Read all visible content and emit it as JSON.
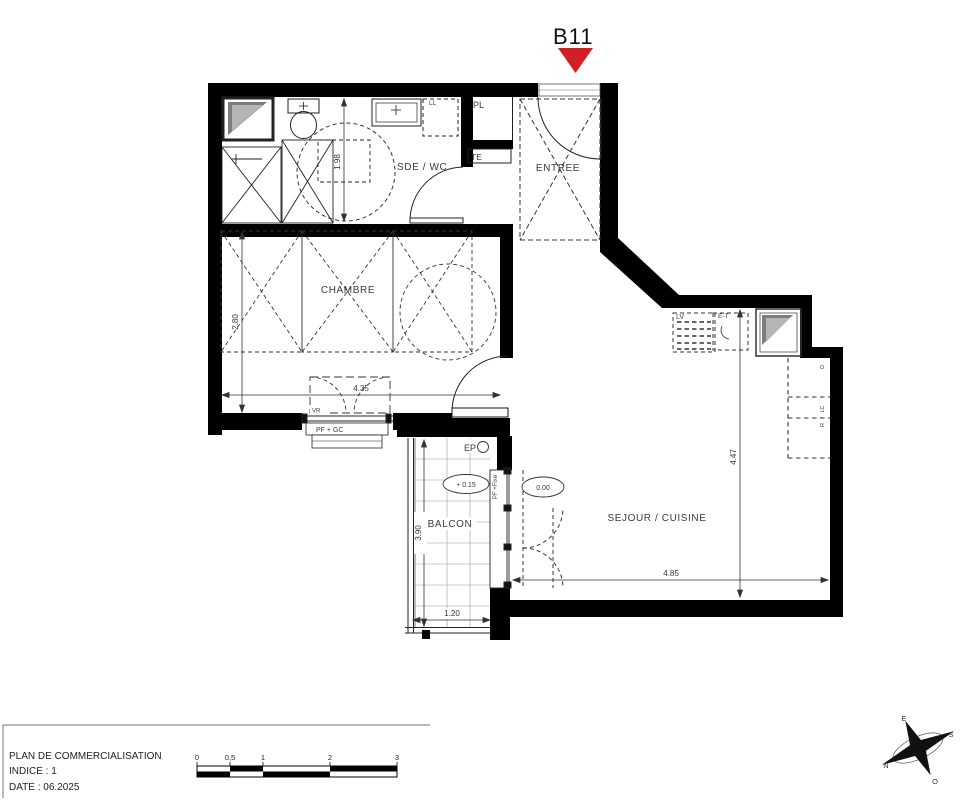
{
  "unit_marker": {
    "label": "B11"
  },
  "colors": {
    "wall": "#000000",
    "marker_red": "#d11f26",
    "text": "#333333"
  },
  "rooms": {
    "sde_wc": "SDE / WC",
    "entree": "ENTREE",
    "chambre": "CHAMBRE",
    "sejour": "SEJOUR / CUISINE",
    "balcon": "BALCON"
  },
  "fixtures": {
    "ll": "LL",
    "pl": "PL",
    "te": "TE",
    "lv": "LV",
    "et": "E-T",
    "vr": "VR",
    "pf_gc": "PF + GC",
    "pf_fixe": "PF +Fixe",
    "ep": "EP",
    "col_o": "O",
    "col_lc": "LC",
    "col_r": "R"
  },
  "levels": {
    "balcony": "+ 0.15",
    "interior": "0.00"
  },
  "dimensions": {
    "sde_depth": "1.98",
    "chambre_width": "2.80",
    "chambre_length": "4.35",
    "sejour_depth": "4.47",
    "sejour_width": "4.85",
    "balcon_depth": "3.90",
    "balcon_width": "1.20"
  },
  "title_block": {
    "line1": "PLAN DE COMMERCIALISATION",
    "line2": "INDICE : 1",
    "line3": "DATE :  06.2025"
  },
  "scale_bar": {
    "labels": [
      "0",
      "0,5",
      "1",
      "2",
      "3"
    ]
  },
  "compass": {
    "n": "N",
    "s": "S",
    "e": "E",
    "w": "O"
  }
}
